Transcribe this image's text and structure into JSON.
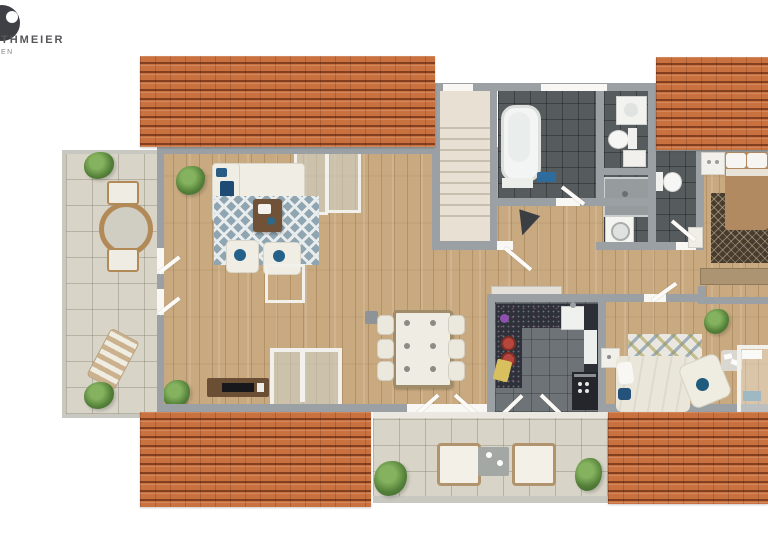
{
  "logo": {
    "company_fragment": "THMEIER",
    "tagline_fragment": "EN"
  },
  "colors": {
    "roof": "#c9723f",
    "wood_floor": "#c9aa80",
    "wall": "#9aa0a3",
    "bath_tile": "#565b5e",
    "kitchen_tile": "#6d7376",
    "terrace_tile": "#d8d4c8",
    "stair": "#e7e0d3",
    "rug_blue": "#8fa5b2",
    "accent_blue": "#24618a",
    "counter_dark": "#2e313a",
    "bed_tan": "#b28a61",
    "plant_green": "#527f38",
    "logo_text": "#55565a"
  },
  "scene_elements": [
    "tiled-roof",
    "side-terrace",
    "living-room",
    "dining-area",
    "kitchen",
    "main-bathroom",
    "second-bathroom",
    "shower-utility-room",
    "wc",
    "staircase",
    "bedroom",
    "guest-bedroom",
    "rear-balcony"
  ]
}
